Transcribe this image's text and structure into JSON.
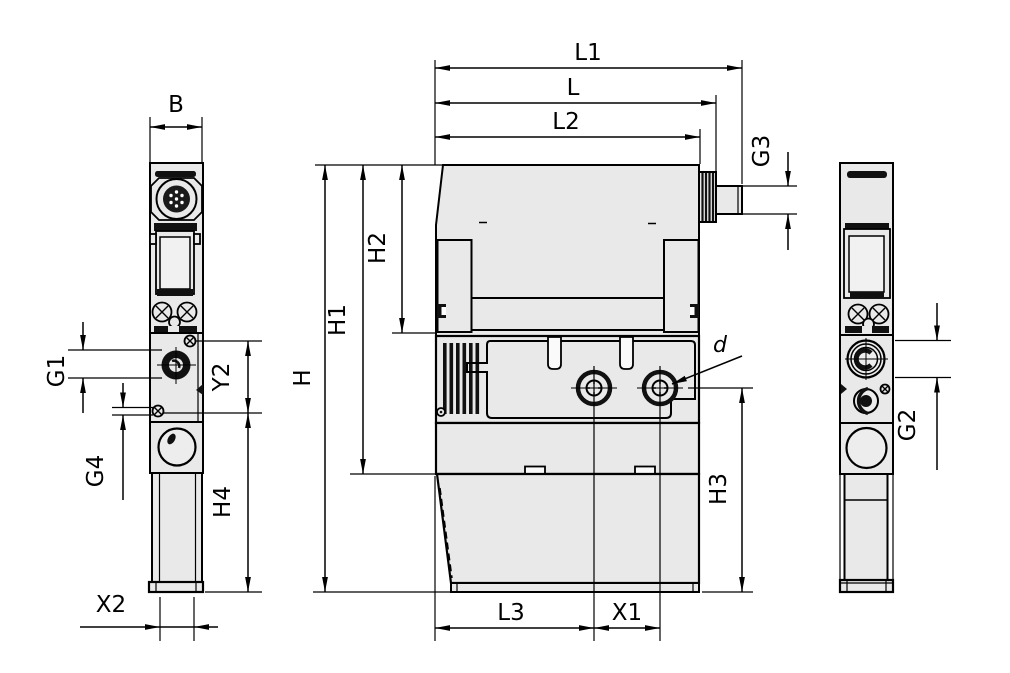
{
  "drawing_colors": {
    "background": "#ffffff",
    "line_color": "#000000",
    "body_fill": "#e9e9e9"
  },
  "labels": {
    "B": "B",
    "L1": "L1",
    "L": "L",
    "L2": "L2",
    "G3": "G3",
    "H": "H",
    "H1": "H1",
    "H2": "H2",
    "G1": "G1",
    "G4": "G4",
    "Y2": "Y2",
    "H4": "H4",
    "X2": "X2",
    "L3": "L3",
    "X1": "X1",
    "H3": "H3",
    "G2": "G2",
    "d": "d"
  }
}
